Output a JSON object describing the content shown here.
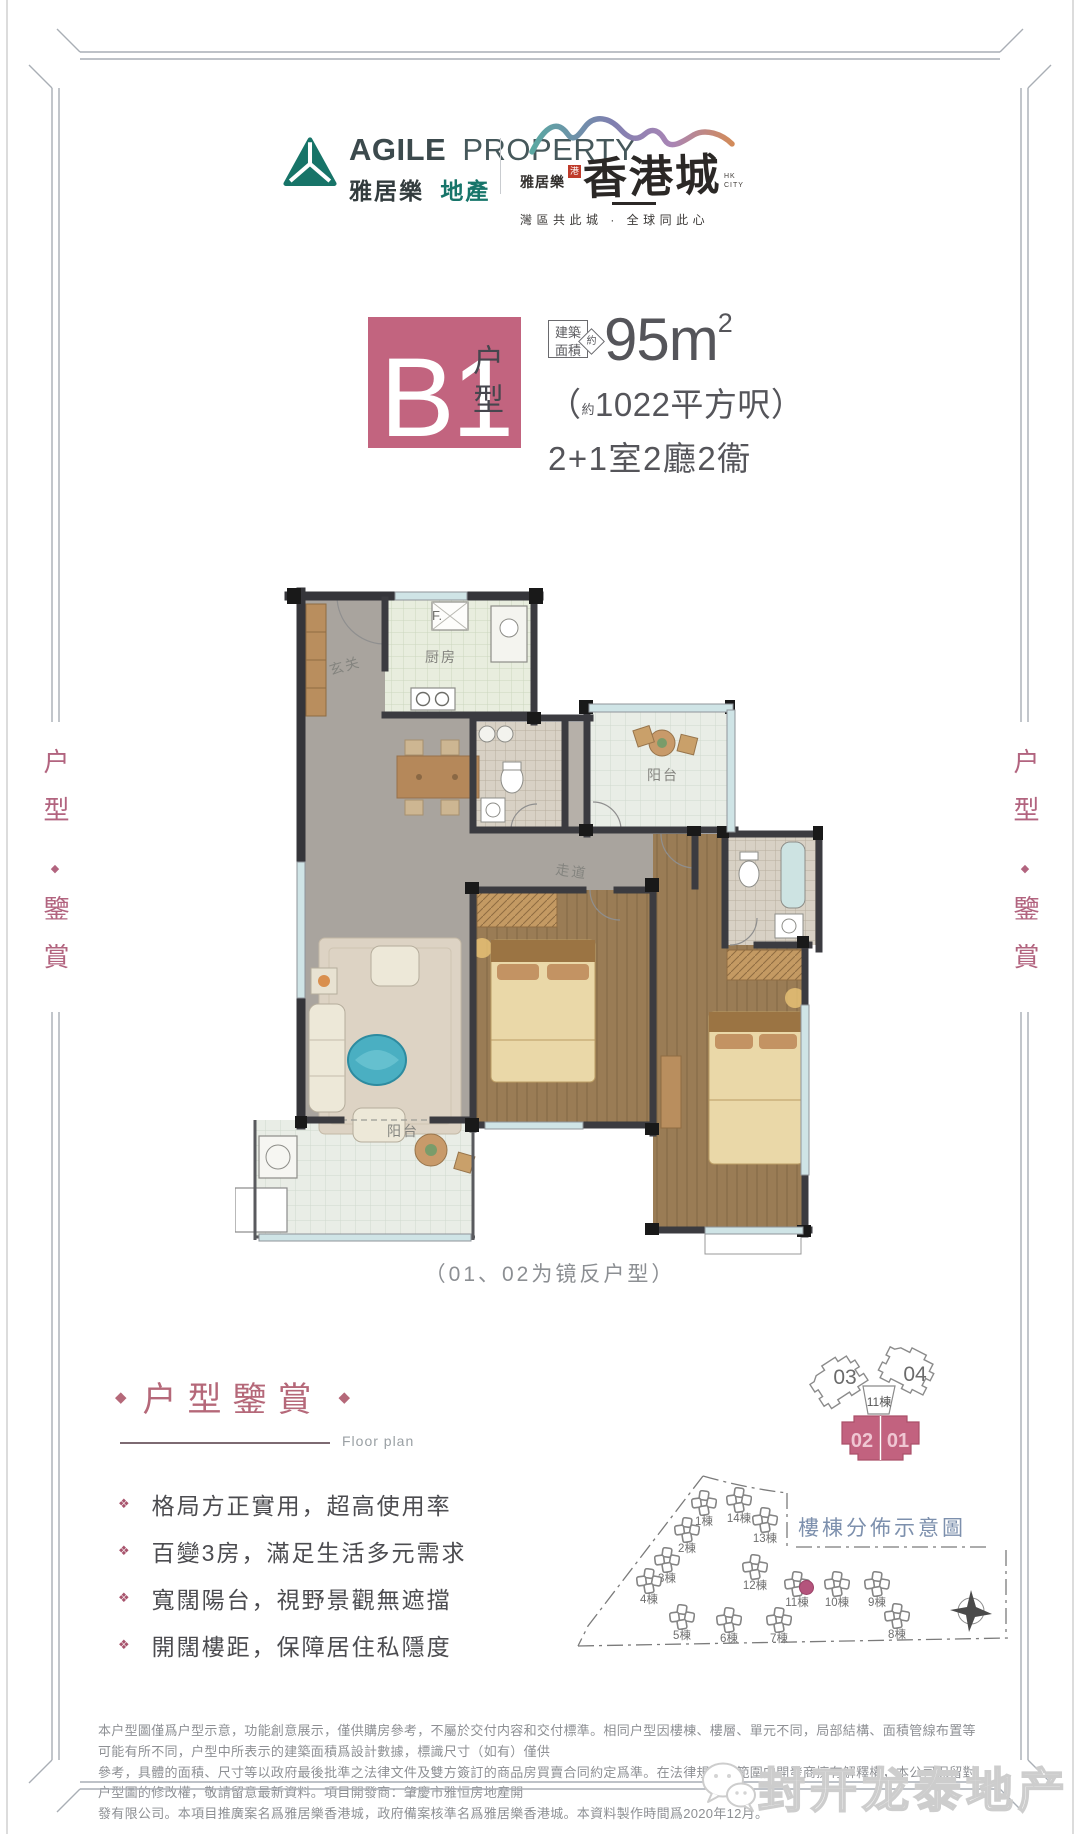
{
  "colors": {
    "accent_pink": "#c2647f",
    "brand_teal": "#177468",
    "mauve": "#b2647f",
    "siteplan_title_blue": "#7d90ad"
  },
  "icons": {
    "diamond": "◆",
    "bullet_diamond": "❖",
    "wechat": "wechat-bubbles"
  },
  "brand": {
    "agile_en_bold": "AGILE",
    "agile_en_light": "PROPERTY",
    "agile_cn_bold": "雅居樂",
    "agile_cn_teal": "地產",
    "hk_prefix": "雅居樂",
    "hk_seal": "港",
    "hk_name": "香港城",
    "hk_sub": "HK CITY",
    "hk_tagline": "灣區共此城 · 全球同此心"
  },
  "unit": {
    "code": "B1",
    "type_label": "户型",
    "area_box_line1": "建築",
    "area_box_line2": "面積",
    "area_about": "約",
    "area_value": "95m",
    "area_sup": "2",
    "ft_open": "（",
    "ft_about": "約",
    "ft_rest": "1022平方呎）",
    "rooms": "2+1室2廳2衞"
  },
  "floorplan": {
    "caption": "（01、02为镜反户型）",
    "labels": {
      "fridge": "F.",
      "kitchen": "厨房",
      "entry": "玄关",
      "balcony_top": "阳台",
      "corridor": "走道",
      "balcony_bottom": "阳台"
    }
  },
  "side_text": {
    "top": "户型",
    "bottom": "鑒賞"
  },
  "appreciation": {
    "title": "户型鑒賞",
    "subtitle": "Floor plan",
    "bullets": [
      "格局方正實用，超高使用率",
      "百變3房，滿足生活多元需求",
      "寬闊陽台，視野景觀無遮擋",
      "開闊樓距，保障居住私隱度"
    ]
  },
  "tower": {
    "unit_03": "03",
    "unit_04": "04",
    "building": "11棟",
    "unit_02": "02",
    "unit_01": "01"
  },
  "siteplan": {
    "title": "樓棟分佈示意圖",
    "buildings": [
      {
        "label": "1棟",
        "x": 150,
        "y": 40
      },
      {
        "label": "14棟",
        "x": 185,
        "y": 37
      },
      {
        "label": "13棟",
        "x": 211,
        "y": 57
      },
      {
        "label": "2棟",
        "x": 133,
        "y": 67
      },
      {
        "label": "3棟",
        "x": 113,
        "y": 97
      },
      {
        "label": "4棟",
        "x": 95,
        "y": 118
      },
      {
        "label": "5棟",
        "x": 128,
        "y": 154
      },
      {
        "label": "6棟",
        "x": 175,
        "y": 157
      },
      {
        "label": "7棟",
        "x": 225,
        "y": 157
      },
      {
        "label": "12棟",
        "x": 201,
        "y": 104
      },
      {
        "label": "11棟",
        "x": 243,
        "y": 121,
        "highlight": true
      },
      {
        "label": "10棟",
        "x": 283,
        "y": 121
      },
      {
        "label": "9棟",
        "x": 323,
        "y": 121
      },
      {
        "label": "8棟",
        "x": 343,
        "y": 153
      }
    ]
  },
  "disclaimer": {
    "lines": [
      "本户型圖僅爲户型示意，功能創意展示，僅供購房參考，不屬於交付内容和交付標準。相同户型因樓棟、樓層、單元不同，局部結構、面積管線布置等可能有所不同，户型中所表示的建築面積爲設計數據，標識尺寸（如有）僅供",
      "參考，具體的面積、尺寸等以政府最後批準之法律文件及雙方簽訂的商品房買賣合同約定爲準。在法律規定的範圍内開發商擁有解釋權，本公司保留對户型圖的修改權，敬請留意最新資料。項目開發商：肇慶市雅恒房地產開",
      "發有限公司。本項目推廣案名爲雅居樂香港城，政府備案核準名爲雅居樂香港城。本資料製作時間爲2020年12月。"
    ]
  },
  "watermark": {
    "text": "封开龙泰地产"
  }
}
